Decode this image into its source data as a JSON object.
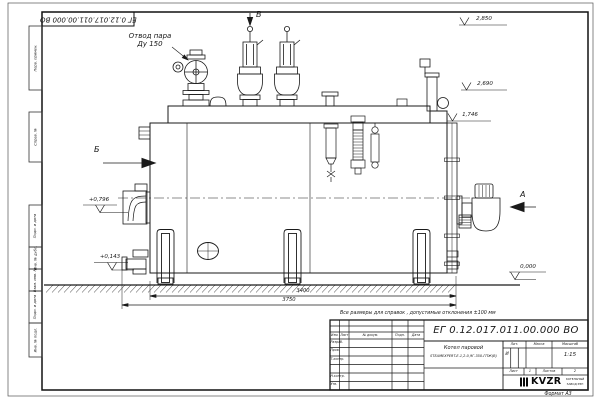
{
  "frame": {
    "doc_number_stamp": "ЕГ 0.12.017.011.00.000  ВО",
    "format_label": "Формат А3",
    "margin_stamps": [
      "Перв. примен.",
      "Справ. №",
      "Подп. и дата",
      "Инв. № дубл.",
      "Взам. инв. №",
      "Подп. и дата",
      "Инв. № подл."
    ]
  },
  "drawing": {
    "callouts": {
      "steam_outlet_line1": "Отвод пара",
      "steam_outlet_line2": "Ду 150"
    },
    "view_markers": {
      "top": "В",
      "left": "Б",
      "right": "А"
    },
    "elevations": {
      "valve_top": "2,850",
      "stack_top": "2,690",
      "shell_top": "1,746",
      "left_upper": "+0,796",
      "left_lower": "+0,143",
      "ground": "0,000"
    },
    "dimensions": {
      "supports_span": "3400",
      "overall_length": "3750"
    }
  },
  "note": "Все размеры для справок , допустимые отклонения ±100 мм",
  "title_block": {
    "doc_number": "ЕГ 0.12.017.011.00.000  ВО",
    "header": {
      "izm": "Изм.",
      "list": "Лист",
      "doc": "№ докум.",
      "podp": "Подп.",
      "data": "Дата"
    },
    "roles": [
      "Разраб.",
      "Пров.",
      "Т.контр.",
      "Н.контр.",
      "Утв."
    ],
    "product_name": "Котел паровой",
    "product_model": "STEAMEXPERT-Е-1,2-0,9Г-350-ГПЖ(В)",
    "lit_label": "Лит.",
    "lit_value": "И",
    "mass_label": "Масса",
    "scale_label": "Масштаб",
    "scale_value": "1:15",
    "sheet_label": "Лист",
    "sheet_value": "1",
    "sheets_label": "Листов",
    "sheets_value": "2",
    "logo_text": "KVZR",
    "logo_caption_line1": "КОТЕЛЬНЫЙ",
    "logo_caption_line2": "ЗАВОД РЭП"
  }
}
